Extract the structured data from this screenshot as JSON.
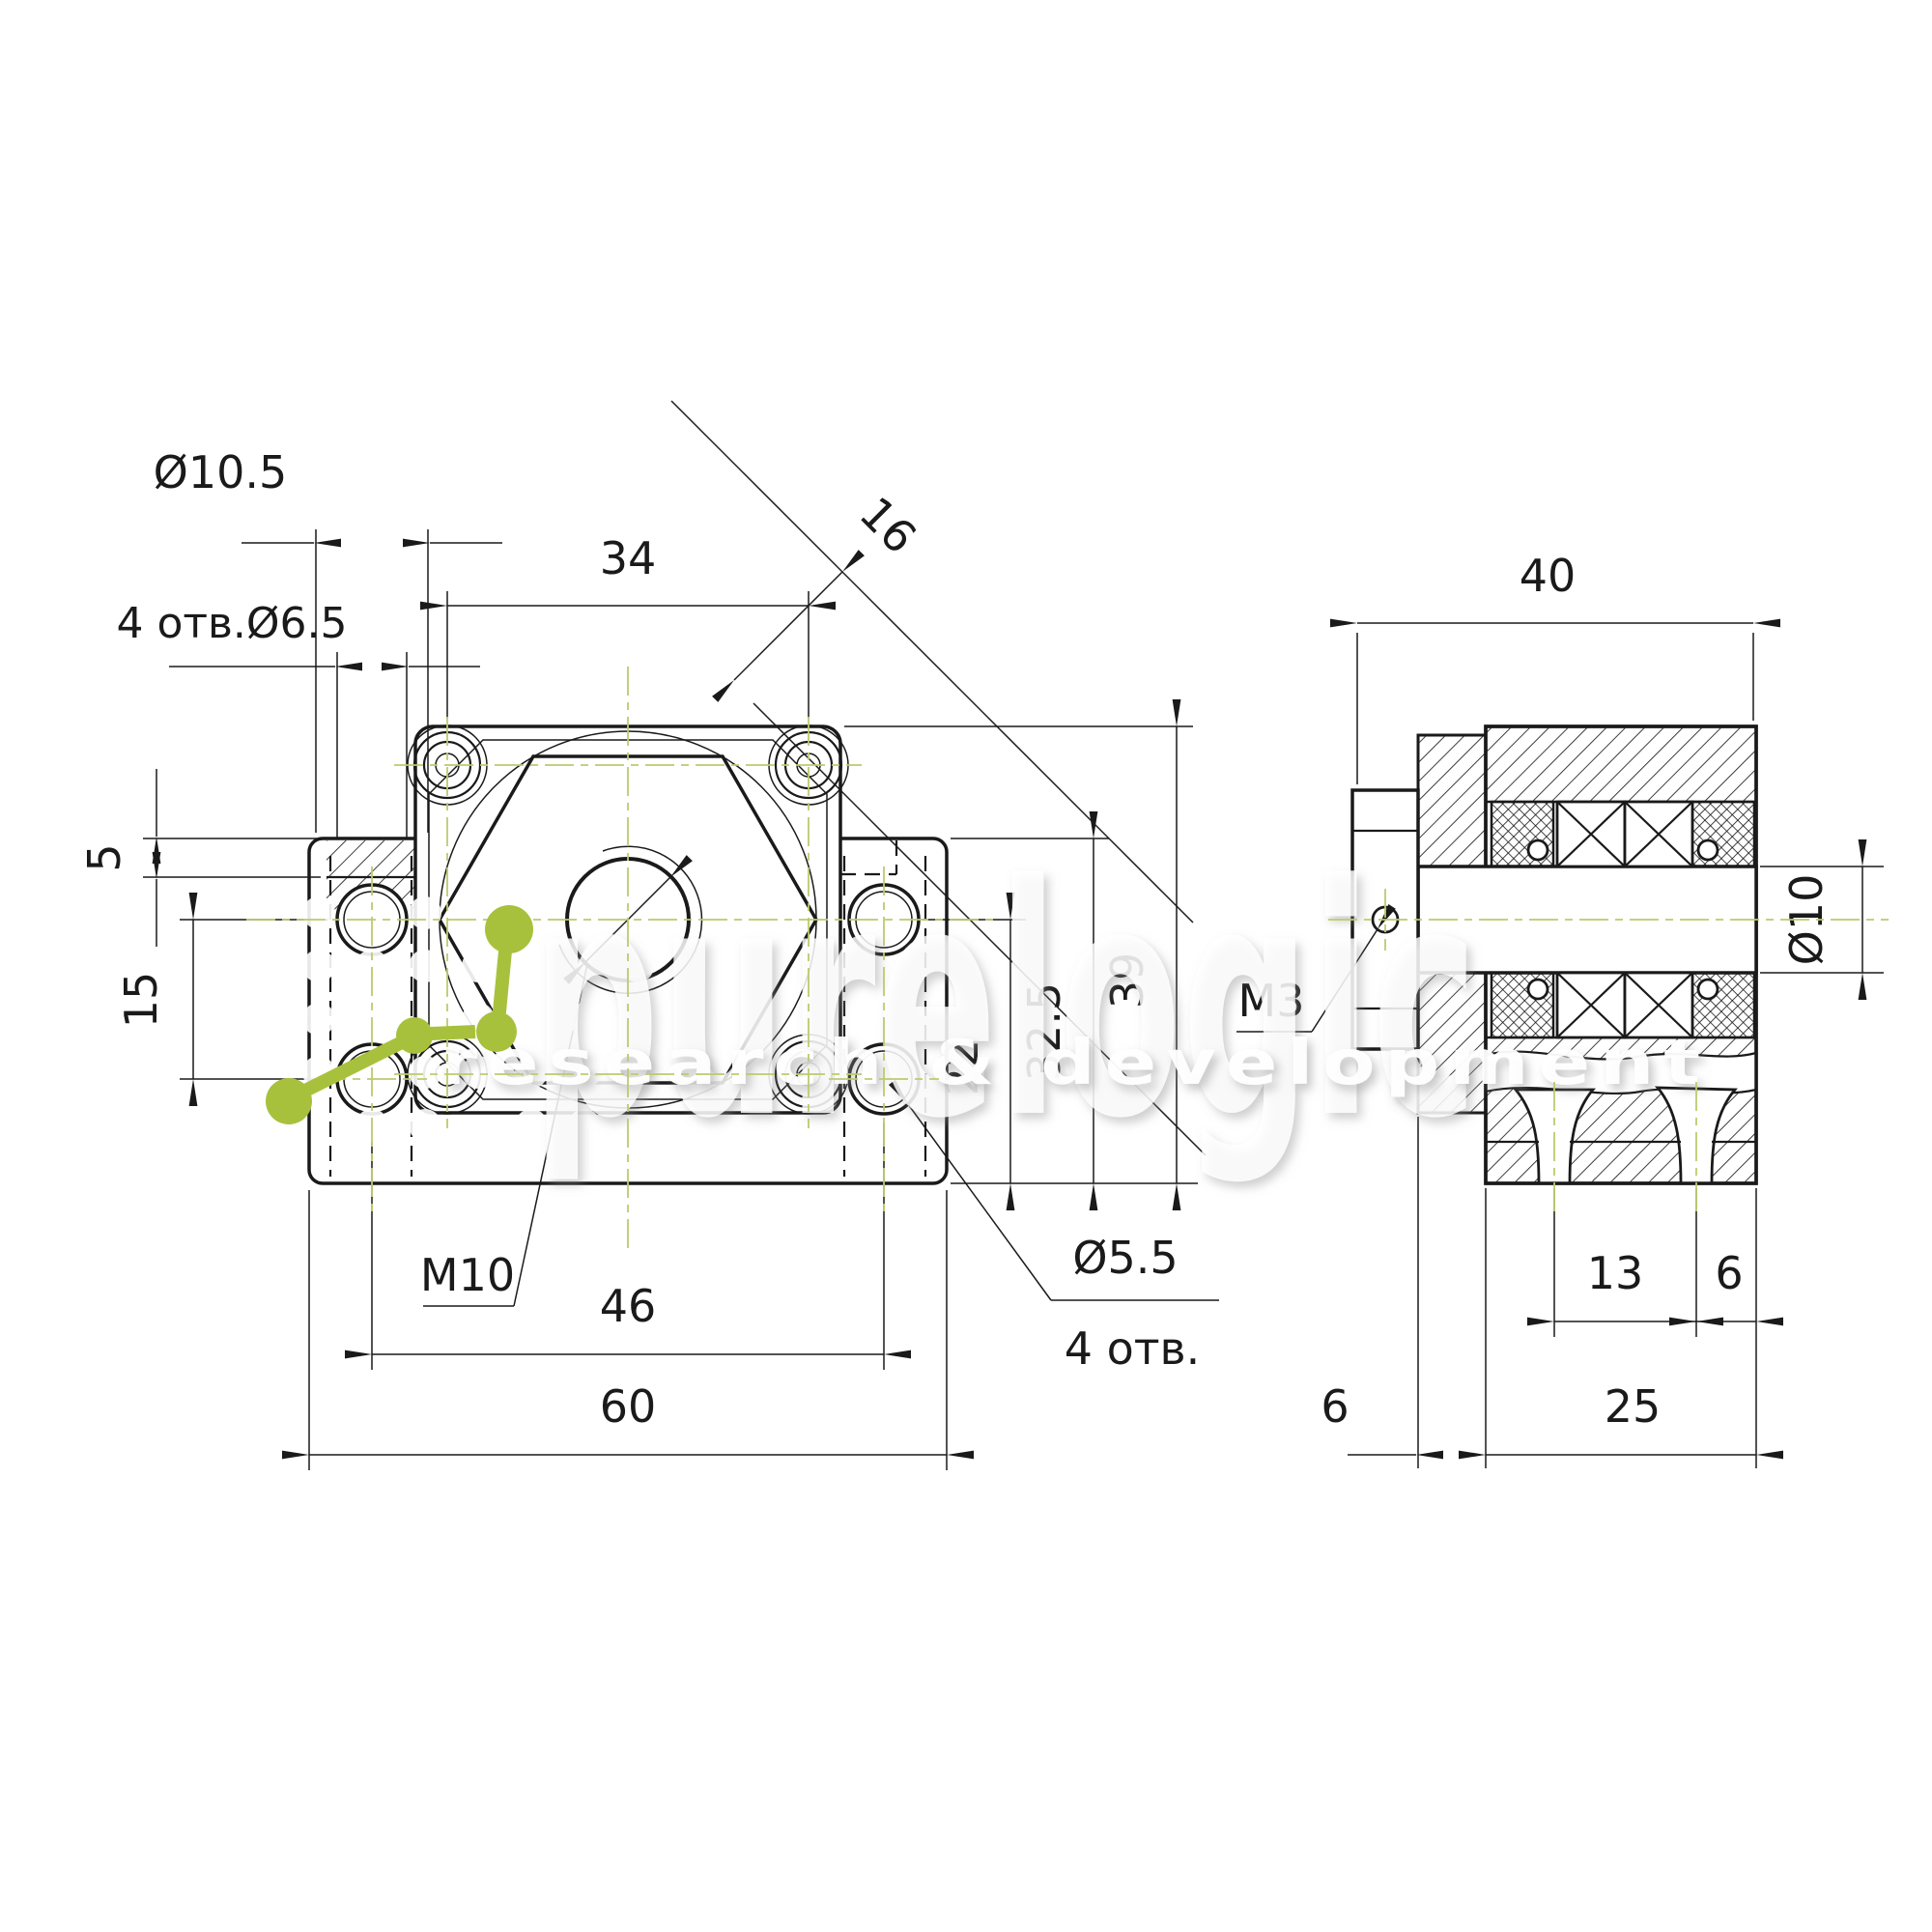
{
  "drawing": {
    "front_view": {
      "dimensions": {
        "counterbore_dia": "Ø10.5",
        "mount_holes_label": "4 отв.Ø6.5",
        "flange_screw_spacing": "34",
        "diagonal_width": "16",
        "step_height": "5",
        "side_hole_spacing": "15",
        "center_thread": "M10",
        "mount_hole_spacing": "46",
        "base_width": "60",
        "flange_hole_dia": "Ø5.5",
        "flange_hole_count": "4 отв.",
        "center_height": "22",
        "body_height": "32.5",
        "total_height": "39"
      }
    },
    "side_view": {
      "dimensions": {
        "overall_depth": "40",
        "setscrew_thread": "M3",
        "shaft_dia": "Ø10",
        "bearing_spacing": "13",
        "rear_offset": "6",
        "flange_thickness": "6",
        "body_depth": "25"
      }
    },
    "watermark": {
      "brand": "purelogic",
      "tagline": "research & development"
    }
  }
}
